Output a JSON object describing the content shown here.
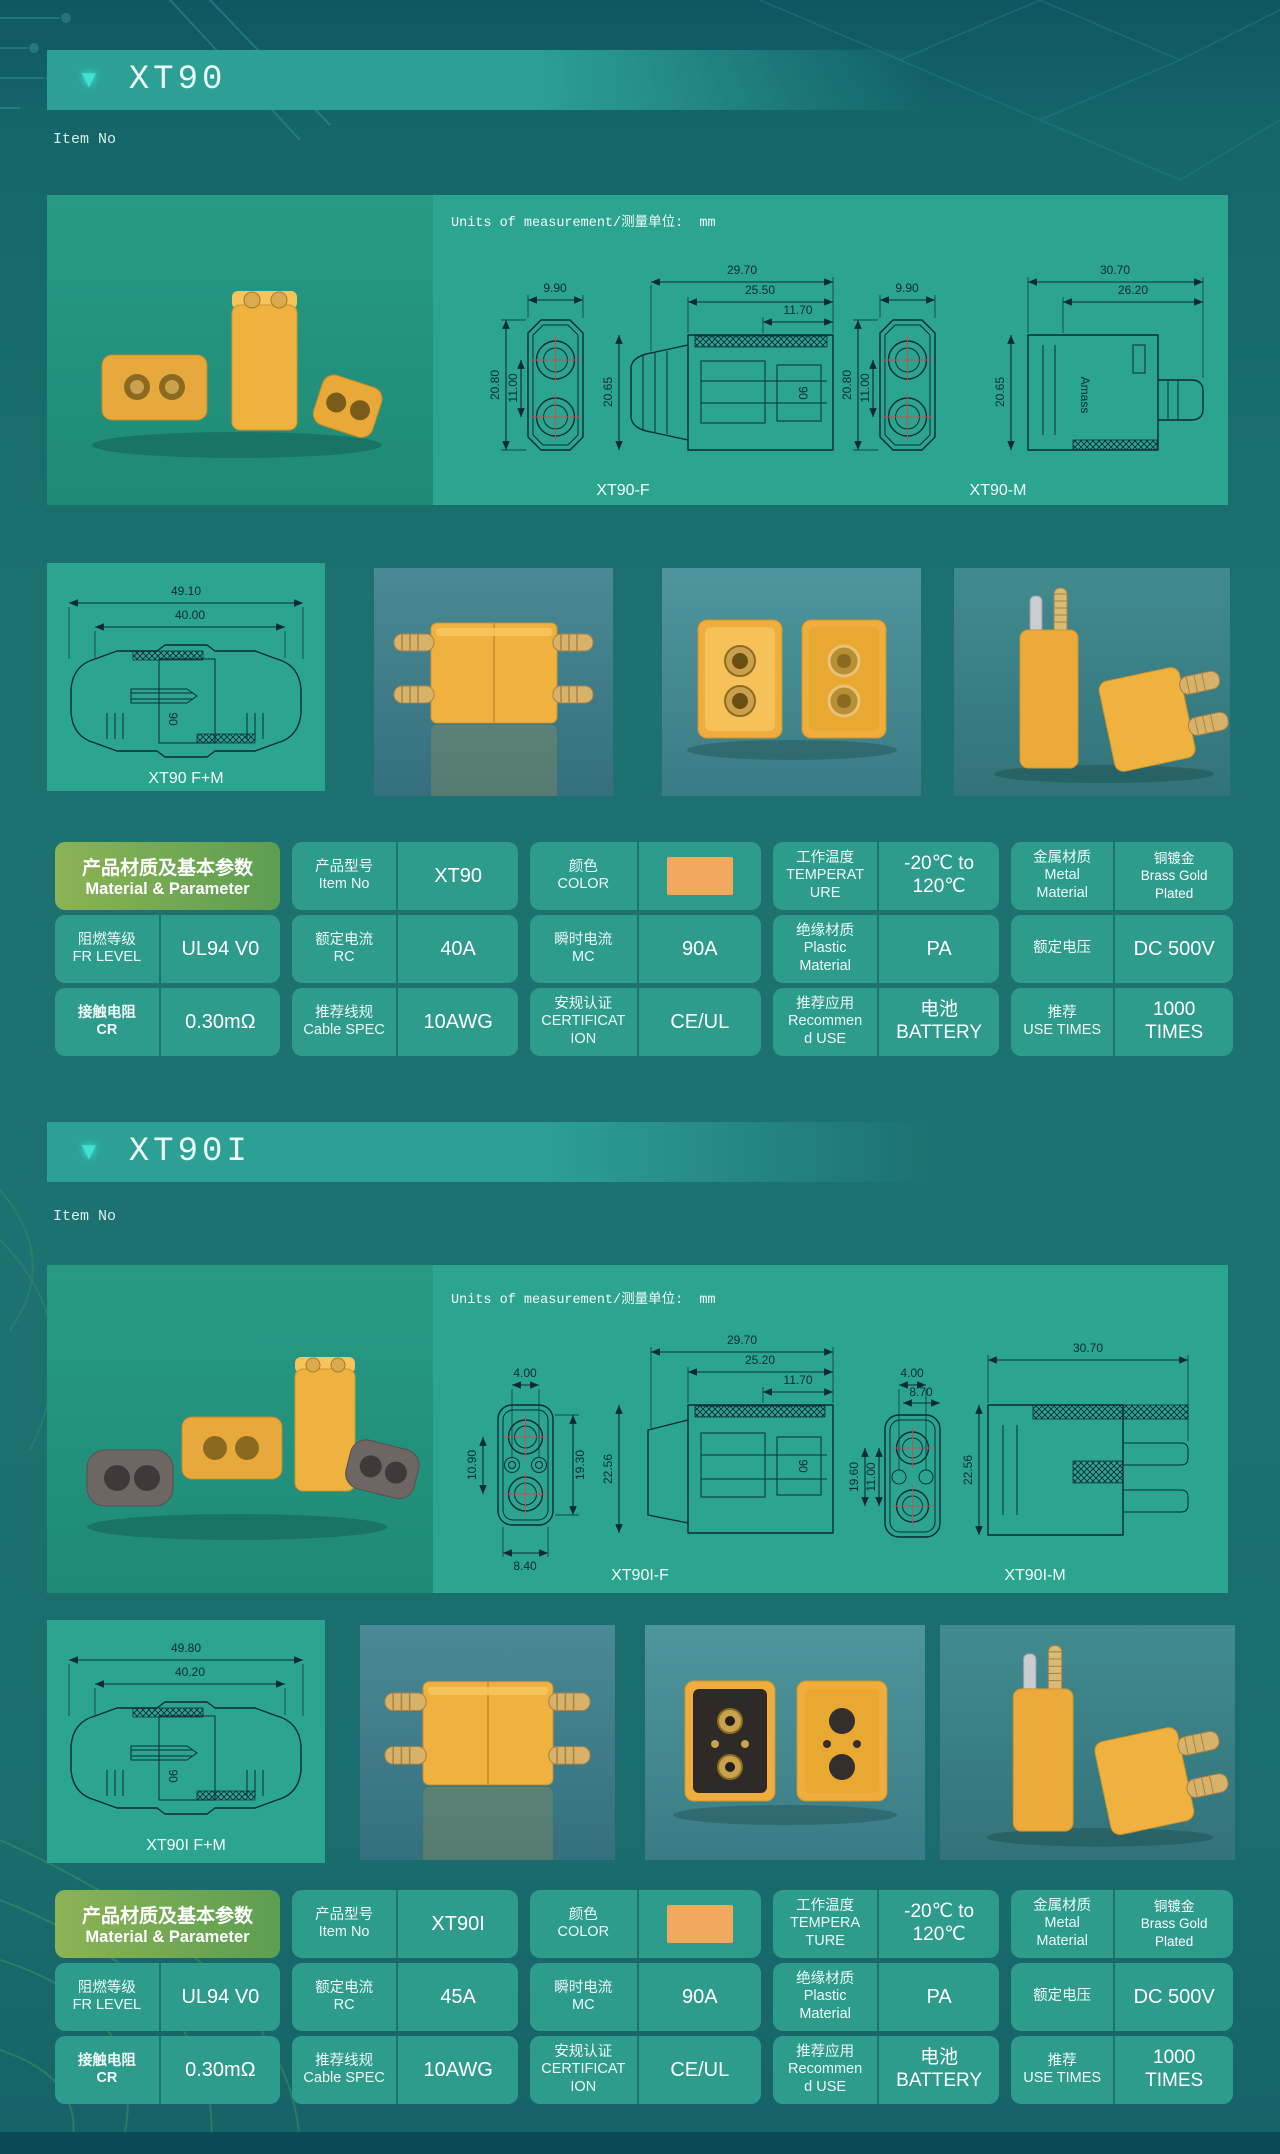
{
  "colors": {
    "connector_orange": "#f2a95c",
    "panel_teal": "#2ba58f",
    "cell_teal": "#2d9c8c",
    "header_green": "#79aa50",
    "accent_cyan": "#3ae2d8",
    "background": "#1d7170",
    "drawing_ink": "#0e2a38"
  },
  "sections": [
    {
      "id": "xt90",
      "header_label": "XT90",
      "item_no_label": "Item No",
      "units_label": "Units of measurement/测量单位:  mm",
      "drawings": {
        "emboss": "90",
        "brand": "Amass",
        "female": {
          "label": "XT90-F",
          "front": {
            "top": "9.90",
            "left": "20.80",
            "inner": "11.00"
          },
          "side": {
            "d1": "29.70",
            "d2": "25.50",
            "d3": "11.70",
            "left": "20.65"
          }
        },
        "male": {
          "label": "XT90-M",
          "front": {
            "top": "9.90",
            "left": "20.80",
            "inner": "11.00"
          },
          "side": {
            "d1": "30.70",
            "d2": "26.20",
            "left": "20.65"
          }
        },
        "pair": {
          "label": "XT90 F+M",
          "outer": "49.10",
          "inner": "40.00"
        }
      },
      "table": {
        "rows": [
          [
            {
              "type": "green",
              "lines": [
                "产品材质及基本参数",
                "Material & Parameter"
              ]
            },
            {
              "label": [
                "产品型号",
                "Item No"
              ],
              "value": "XT90"
            },
            {
              "label": [
                "颜色",
                "COLOR"
              ],
              "swatch": true
            },
            {
              "label": [
                "工作温度",
                "TEMPERAT",
                "URE"
              ],
              "value_lines": [
                "-20℃ to",
                "120℃"
              ]
            },
            {
              "label": [
                "金属材质",
                "Metal",
                "Material"
              ],
              "value_lines": [
                "铜镀金",
                "Brass Gold",
                "Plated"
              ],
              "small": true
            }
          ],
          [
            {
              "label": [
                "阻燃等级",
                "FR LEVEL"
              ],
              "value": "UL94 V0"
            },
            {
              "label": [
                "额定电流",
                "RC"
              ],
              "value": "40A"
            },
            {
              "label": [
                "瞬时电流",
                "MC"
              ],
              "value": "90A"
            },
            {
              "label": [
                "绝缘材质",
                "Plastic",
                "Material"
              ],
              "value": "PA"
            },
            {
              "label": [
                "额定电压"
              ],
              "value": "DC 500V"
            }
          ],
          [
            {
              "label": [
                "接触电阻",
                "CR"
              ],
              "bold": true,
              "value": "0.30mΩ"
            },
            {
              "label": [
                "推荐线规",
                "Cable SPEC"
              ],
              "value": "10AWG"
            },
            {
              "label": [
                "安规认证",
                "CERTIFICAT",
                "ION"
              ],
              "value": "CE/UL"
            },
            {
              "label": [
                "推荐应用",
                "Recommen",
                "d USE"
              ],
              "value_lines": [
                "电池",
                "BATTERY"
              ]
            },
            {
              "label": [
                "推荐",
                "USE TIMES"
              ],
              "value_lines": [
                "1000",
                "TIMES"
              ]
            }
          ]
        ]
      }
    },
    {
      "id": "xt90i",
      "header_label": "XT90I",
      "item_no_label": "Item No",
      "units_label": "Units of measurement/测量单位:  mm",
      "drawings": {
        "female": {
          "label": "XT90I-F",
          "front": {
            "top": "4.00",
            "left": "10.90",
            "right": "19.30",
            "bottom": "8.40"
          },
          "side": {
            "d1": "29.70",
            "d2": "25.20",
            "d3": "11.70",
            "left": "22.56"
          }
        },
        "male": {
          "label": "XT90I-M",
          "front": {
            "top": "4.00",
            "top2": "8.70",
            "left": "19.60",
            "inner": "11.00"
          },
          "side": {
            "d1": "30.70",
            "left": "22.56"
          }
        },
        "pair": {
          "label": "XT90I F+M",
          "outer": "49.80",
          "inner": "40.20"
        }
      },
      "table": {
        "rows": [
          [
            {
              "type": "green",
              "lines": [
                "产品材质及基本参数",
                "Material & Parameter"
              ]
            },
            {
              "label": [
                "产品型号",
                "Item No"
              ],
              "value": "XT90I"
            },
            {
              "label": [
                "颜色",
                "COLOR"
              ],
              "swatch": true
            },
            {
              "label": [
                "工作温度",
                "TEMPERA",
                "TURE"
              ],
              "value_lines": [
                "-20℃ to",
                "120℃"
              ]
            },
            {
              "label": [
                "金属材质",
                "Metal",
                "Material"
              ],
              "value_lines": [
                "铜镀金",
                "Brass Gold",
                "Plated"
              ],
              "small": true
            }
          ],
          [
            {
              "label": [
                "阻燃等级",
                "FR LEVEL"
              ],
              "value": "UL94 V0"
            },
            {
              "label": [
                "额定电流",
                "RC"
              ],
              "value": "45A"
            },
            {
              "label": [
                "瞬时电流",
                "MC"
              ],
              "value": "90A"
            },
            {
              "label": [
                "绝缘材质",
                "Plastic",
                "Material"
              ],
              "value": "PA"
            },
            {
              "label": [
                "额定电压"
              ],
              "value": "DC 500V"
            }
          ],
          [
            {
              "label": [
                "接触电阻",
                "CR"
              ],
              "bold": true,
              "value": "0.30mΩ"
            },
            {
              "label": [
                "推荐线规",
                "Cable SPEC"
              ],
              "value": "10AWG"
            },
            {
              "label": [
                "安规认证",
                "CERTIFICAT",
                "ION"
              ],
              "value": "CE/UL"
            },
            {
              "label": [
                "推荐应用",
                "Recommen",
                "d USE"
              ],
              "value_lines": [
                "电池",
                "BATTERY"
              ]
            },
            {
              "label": [
                "推荐",
                "USE TIMES"
              ],
              "value_lines": [
                "1000",
                "TIMES"
              ]
            }
          ]
        ]
      }
    }
  ]
}
